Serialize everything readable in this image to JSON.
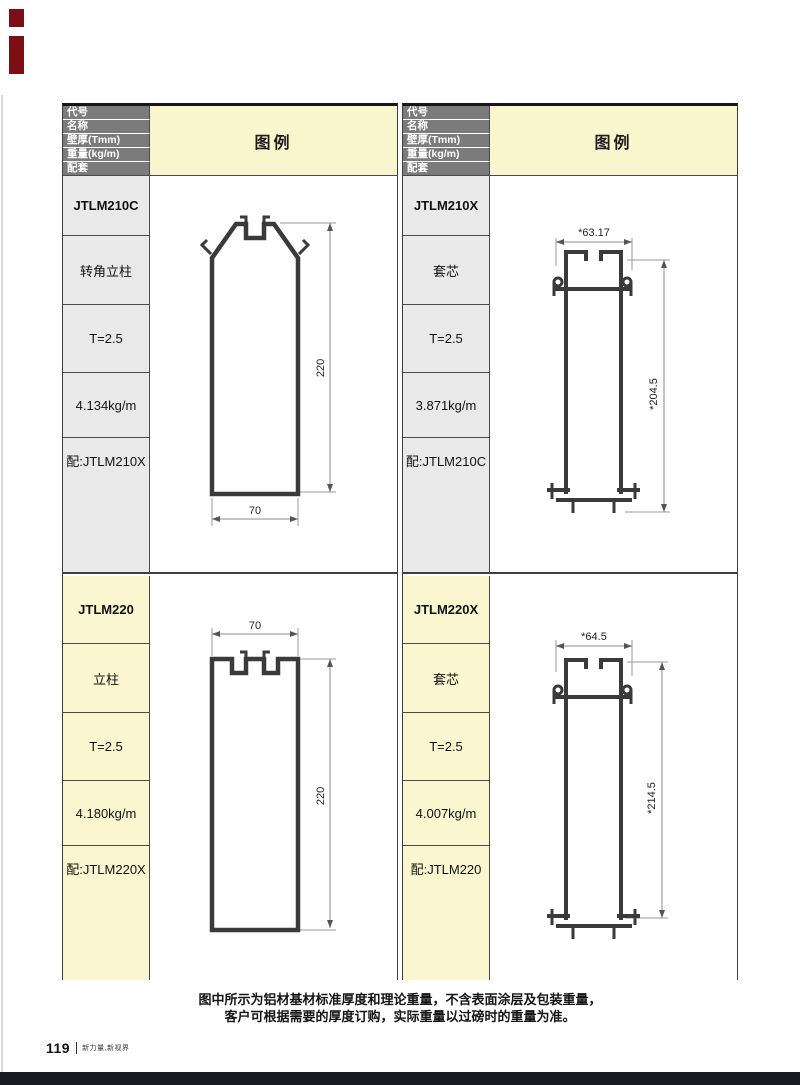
{
  "page": {
    "page_number": "119",
    "page_footer_text": "新力量,新视界",
    "note_line1": "图中所示为铝材基材标准厚度和理论重量，不含表面涂层及包装重量，",
    "note_line2": "客户可根据需要的厚度订购，实际重量以过磅时的重量为准。"
  },
  "table_header": {
    "row_labels": [
      "代号",
      "名称",
      "壁厚(Tmm)",
      "重量(kg/m)",
      "配套"
    ],
    "legend_label": "图例"
  },
  "colors": {
    "header_bg": "#7b7b7b",
    "legend_bg": "#f9f5cc",
    "cell_gray": "#e9e9e9",
    "cell_yellow": "#faf6d0",
    "profile_stroke": "#3a3a3a",
    "accent_red": "#7a1016",
    "bottom_bar": "#1b1b24"
  },
  "profiles": [
    {
      "code": "JTLM210C",
      "name": "转角立柱",
      "thickness": "T=2.5",
      "weight": "4.134kg/m",
      "match": "配:JTLM210X",
      "dims": {
        "height": "220",
        "width": "70"
      }
    },
    {
      "code": "JTLM210X",
      "name": "套芯",
      "thickness": "T=2.5",
      "weight": "3.871kg/m",
      "match": "配:JTLM210C",
      "dims": {
        "width": "*63.17",
        "height": "*204.5"
      }
    },
    {
      "code": "JTLM220",
      "name": "立柱",
      "thickness": "T=2.5",
      "weight": "4.180kg/m",
      "match": "配:JTLM220X",
      "dims": {
        "width": "70",
        "height": "220"
      }
    },
    {
      "code": "JTLM220X",
      "name": "套芯",
      "thickness": "T=2.5",
      "weight": "4.007kg/m",
      "match": "配:JTLM220",
      "dims": {
        "width": "*64.5",
        "height": "*214.5"
      }
    }
  ]
}
